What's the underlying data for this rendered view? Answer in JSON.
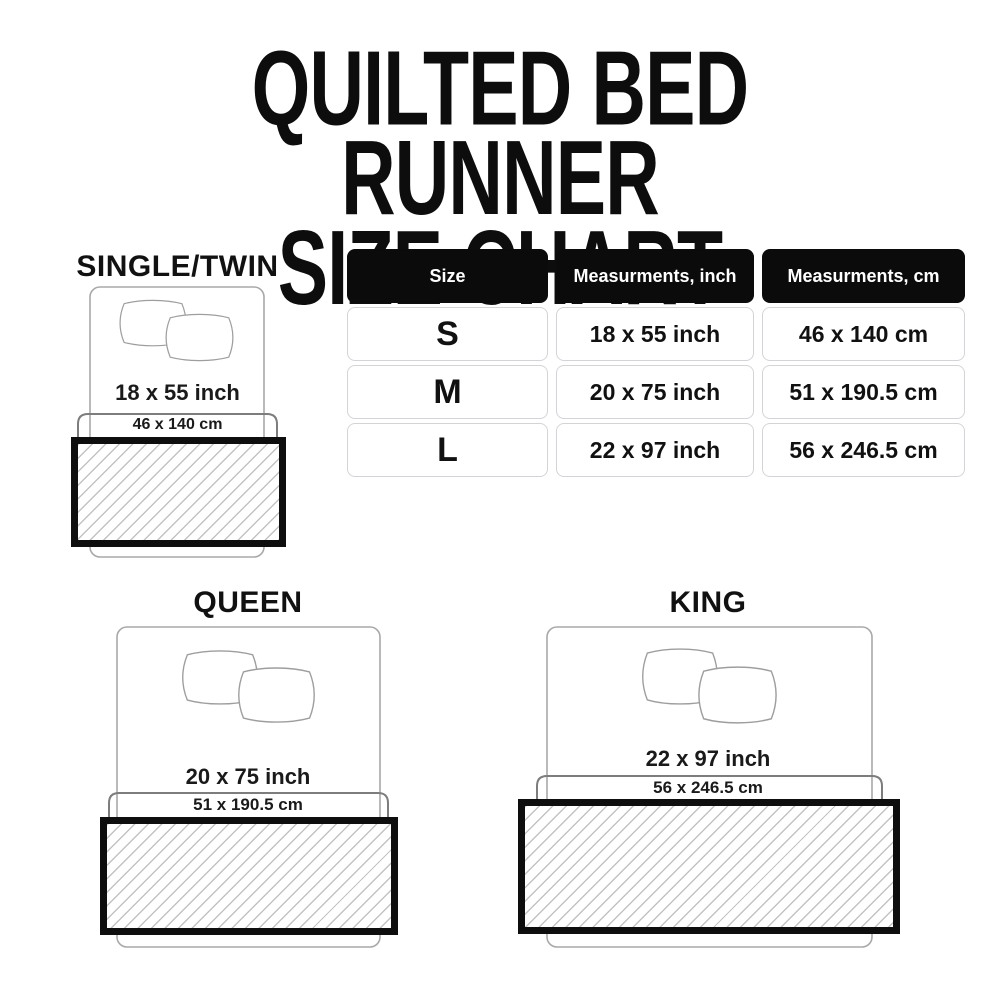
{
  "title": {
    "line1": "QUILTED BED RUNNER",
    "line2": "SIZE CHART"
  },
  "chart_data": {
    "type": "table",
    "title": "QUILTED BED RUNNER SIZE CHART",
    "columns": [
      "Size",
      "Measurments, inch",
      "Measurments, cm"
    ],
    "rows": [
      [
        "S",
        "18 x 55 inch",
        "46 x 140 cm"
      ],
      [
        "M",
        "20 x 75 inch",
        "51 x 190.5 cm"
      ],
      [
        "L",
        "22 x 97 inch",
        "56 x 246.5 cm"
      ]
    ]
  },
  "diagrams": [
    {
      "label": "SINGLE/TWIN",
      "size_inch": "18 x 55 inch",
      "size_cm": "46 x 140 cm"
    },
    {
      "label": "QUEEN",
      "size_inch": "20 x 75 inch",
      "size_cm": "51 x 190.5 cm"
    },
    {
      "label": "KING",
      "size_inch": "22 x 97 inch",
      "size_cm": "56 x 246.5 cm"
    }
  ],
  "colors": {
    "ink": "#0d0d0d",
    "table_header_bg": "#0b0b0b",
    "table_cell_border": "#d2d4d8",
    "bed_outline": "#a8a8a8",
    "bracket": "#7d7d7d",
    "hatch_line": "#c3c3c3",
    "runner_border": "#0e0e0e"
  }
}
